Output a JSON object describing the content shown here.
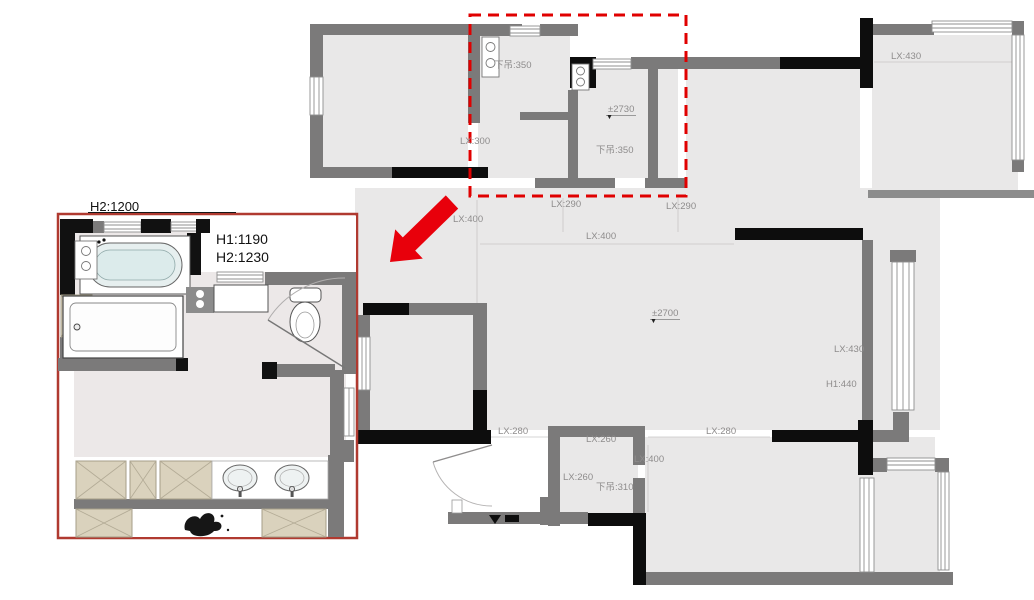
{
  "colors": {
    "floor": "#e9e8e8",
    "wall_gray": "#7b7a7a",
    "wall_black": "#0d0d0d",
    "dashed_highlight_red": "#e00000",
    "arrow_red": "#e8000b",
    "inset_border_red": "#b03a30",
    "dim_label_gray": "#8e8c8c",
    "tan_cabinet": "#dad2bd",
    "tub_fill": "#e6efef"
  },
  "icons": {
    "elevation_marker": "▼"
  },
  "main_plan": {
    "labels": [
      {
        "text": "下吊:350"
      },
      {
        "text": "LX:300"
      },
      {
        "text": "下吊:350"
      },
      {
        "text": "LX:430"
      },
      {
        "text": "LX:400"
      },
      {
        "text": "LX:290"
      },
      {
        "text": "LX:290"
      },
      {
        "text": "LX:400"
      },
      {
        "text": "LX:430"
      },
      {
        "text": "H1:440"
      },
      {
        "text": "LX:280"
      },
      {
        "text": "LX:260"
      },
      {
        "text": "LX:280"
      },
      {
        "text": "LX:400"
      },
      {
        "text": "LX:260"
      },
      {
        "text": "下吊:310"
      }
    ],
    "elevation_markers": [
      {
        "text": "±2730"
      },
      {
        "text": "±2700"
      }
    ]
  },
  "inset": {
    "top_label": "H2:1200",
    "height_note": {
      "line1": "H1:1190",
      "line2": "H2:1230"
    }
  }
}
